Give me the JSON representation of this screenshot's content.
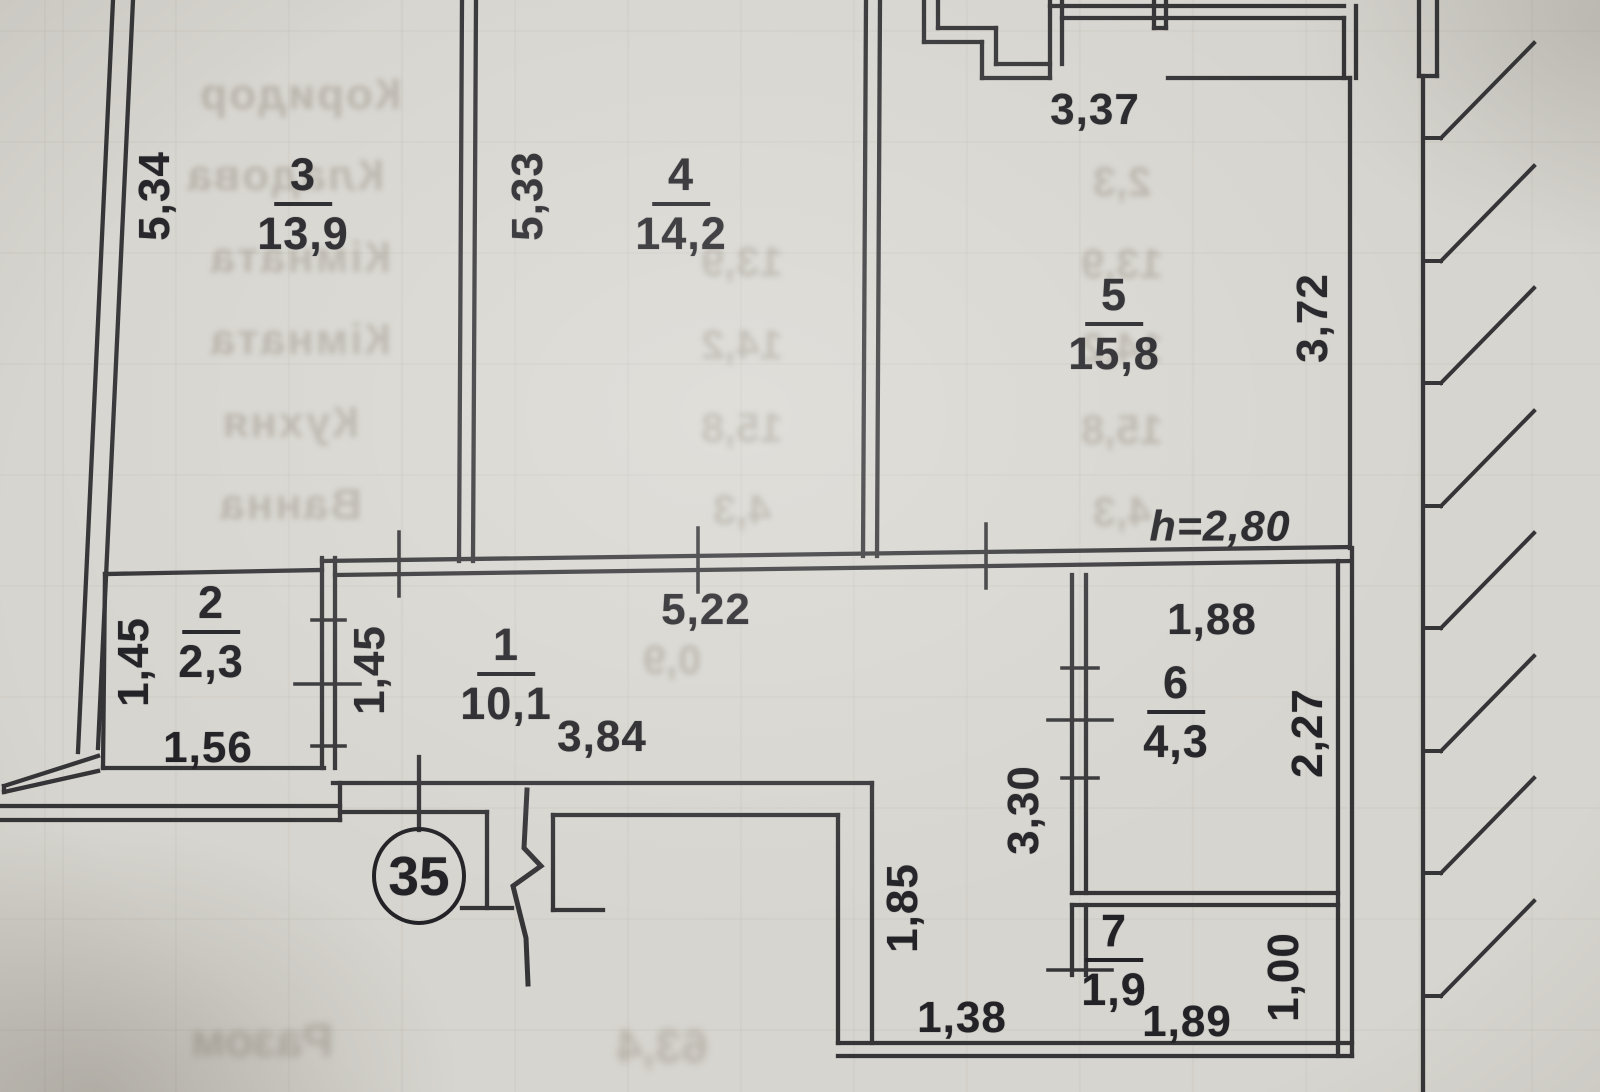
{
  "plan": {
    "apartment_number": "35",
    "ceiling_height": "h=2,80",
    "rooms": [
      {
        "number": "1",
        "area": "10,1"
      },
      {
        "number": "2",
        "area": "2,3"
      },
      {
        "number": "3",
        "area": "13,9"
      },
      {
        "number": "4",
        "area": "14,2"
      },
      {
        "number": "5",
        "area": "15,8"
      },
      {
        "number": "6",
        "area": "4,3"
      },
      {
        "number": "7",
        "area": "1,9"
      }
    ],
    "dimensions": {
      "room1_top": "5,22",
      "room1_bottom": "3,84",
      "room1_left": "1,45",
      "room2_left": "1,45",
      "room2_bottom": "1,56",
      "room3_left": "5,34",
      "room4_left": "5,33",
      "room5_top": "3,37",
      "room5_right": "3,72",
      "room6_top": "1,88",
      "room6_right": "2,27",
      "room6_left": "3,30",
      "room7_bottom": "1,89",
      "room7_right": "1,00",
      "corridor_left": "1,85",
      "corridor_bottom": "1,38"
    },
    "colors": {
      "paper": "#d7d5cf",
      "line": "#2d2d30",
      "ghost": "#766e5f"
    }
  },
  "bleed_through": {
    "rows": [
      {
        "label": "Коридор",
        "value": "10,1"
      },
      {
        "label": "Кладова",
        "value": "2,3"
      },
      {
        "label": "Кімната",
        "value": "13,9"
      },
      {
        "label": "Кімната",
        "value": "14,2"
      },
      {
        "label": "Кухня",
        "value": "15,8"
      },
      {
        "label": "Ванна",
        "value": "4,3"
      }
    ],
    "extra_value": "0,9",
    "total_label": "Разом",
    "total_value": "63,4"
  }
}
